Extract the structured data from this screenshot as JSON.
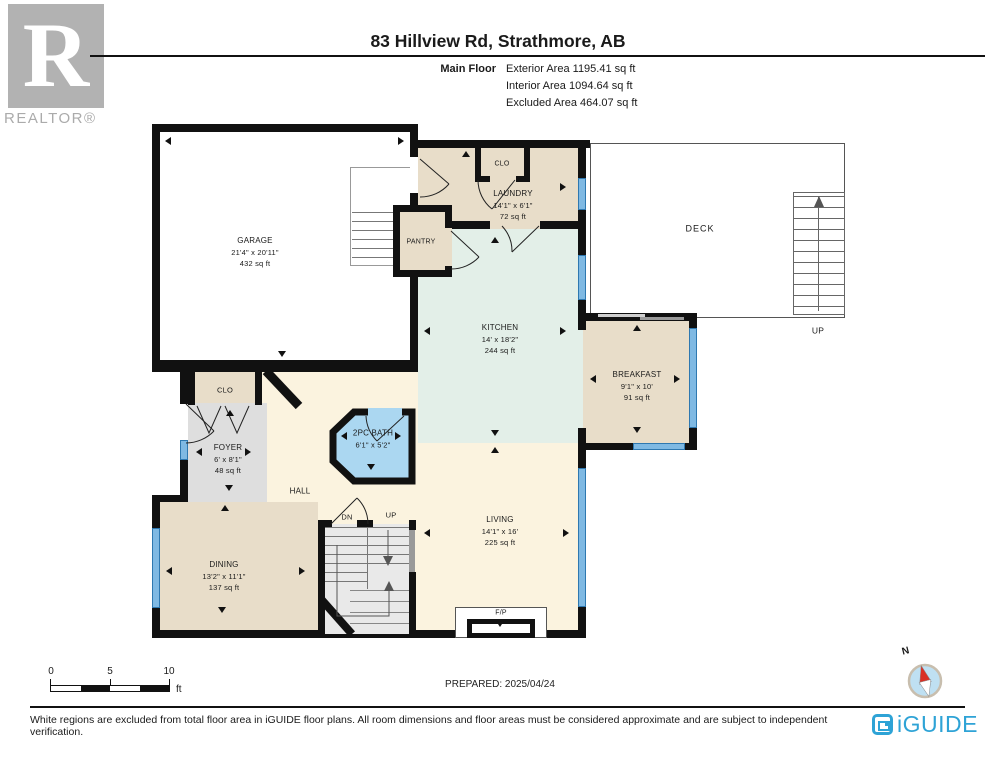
{
  "header": {
    "realtor_r": "R",
    "realtor_text": "REALTOR®",
    "title": "83 Hillview Rd, Strathmore, AB",
    "floor_label": "Main Floor",
    "exterior_area": "Exterior Area 1195.41 sq ft",
    "interior_area": "Interior Area 1094.64 sq ft",
    "excluded_area": "Excluded Area 464.07 sq ft"
  },
  "rooms": {
    "garage": {
      "name": "GARAGE",
      "dims": "21'4\" x 20'11\"",
      "area": "432 sq ft"
    },
    "laundry": {
      "name": "LAUNDRY",
      "dims": "14'1\" x 6'1\"",
      "area": "72 sq ft"
    },
    "kitchen": {
      "name": "KITCHEN",
      "dims": "14' x 18'2\"",
      "area": "244 sq ft"
    },
    "breakfast": {
      "name": "BREAKFAST",
      "dims": "9'1\" x 10'",
      "area": "91 sq ft"
    },
    "foyer": {
      "name": "FOYER",
      "dims": "6' x 8'1\"",
      "area": "48 sq ft"
    },
    "bath": {
      "name": "2PC BATH",
      "dims": "6'1\" x 5'2\""
    },
    "dining": {
      "name": "DINING",
      "dims": "13'2\" x 11'1\"",
      "area": "137 sq ft"
    },
    "living": {
      "name": "LIVING",
      "dims": "14'1\" x 16'",
      "area": "225 sq ft"
    },
    "pantry": {
      "name": "PANTRY"
    },
    "deck": {
      "name": "DECK"
    },
    "hall": {
      "name": "HALL"
    },
    "clo_top": {
      "name": "CLO"
    },
    "clo_foyer": {
      "name": "CLO"
    },
    "fireplace": {
      "name": "F/P"
    }
  },
  "stairs": {
    "dn": "DN",
    "up": "UP",
    "deck_up": "UP"
  },
  "scale": {
    "t0": "0",
    "t5": "5",
    "t10": "10",
    "unit": "ft"
  },
  "prepared": "PREPARED: 2025/04/24",
  "compass": {
    "n": "N"
  },
  "footer": {
    "disclaimer": "White regions are excluded from total floor area in iGUIDE floor plans. All room dimensions and floor areas must be considered approximate and are subject to independent verification.",
    "brand": "iGUIDE"
  },
  "colors": {
    "wall": "#111111",
    "room_beige": "#E8DDC9",
    "kitchen_mint": "#E3EFE8",
    "living_cream": "#FBF3DF",
    "foyer_gray": "#DEDEDE",
    "bath_blue": "#ABD7F1",
    "window_blue": "#7FB9E3",
    "brand_blue": "#2EA3D6",
    "logo_gray": "#B2B2B2"
  },
  "icons": {
    "dimension-arrow": "css-triangle",
    "door-swing": "svg-arc",
    "compass-needle": "red-white-diamond"
  }
}
